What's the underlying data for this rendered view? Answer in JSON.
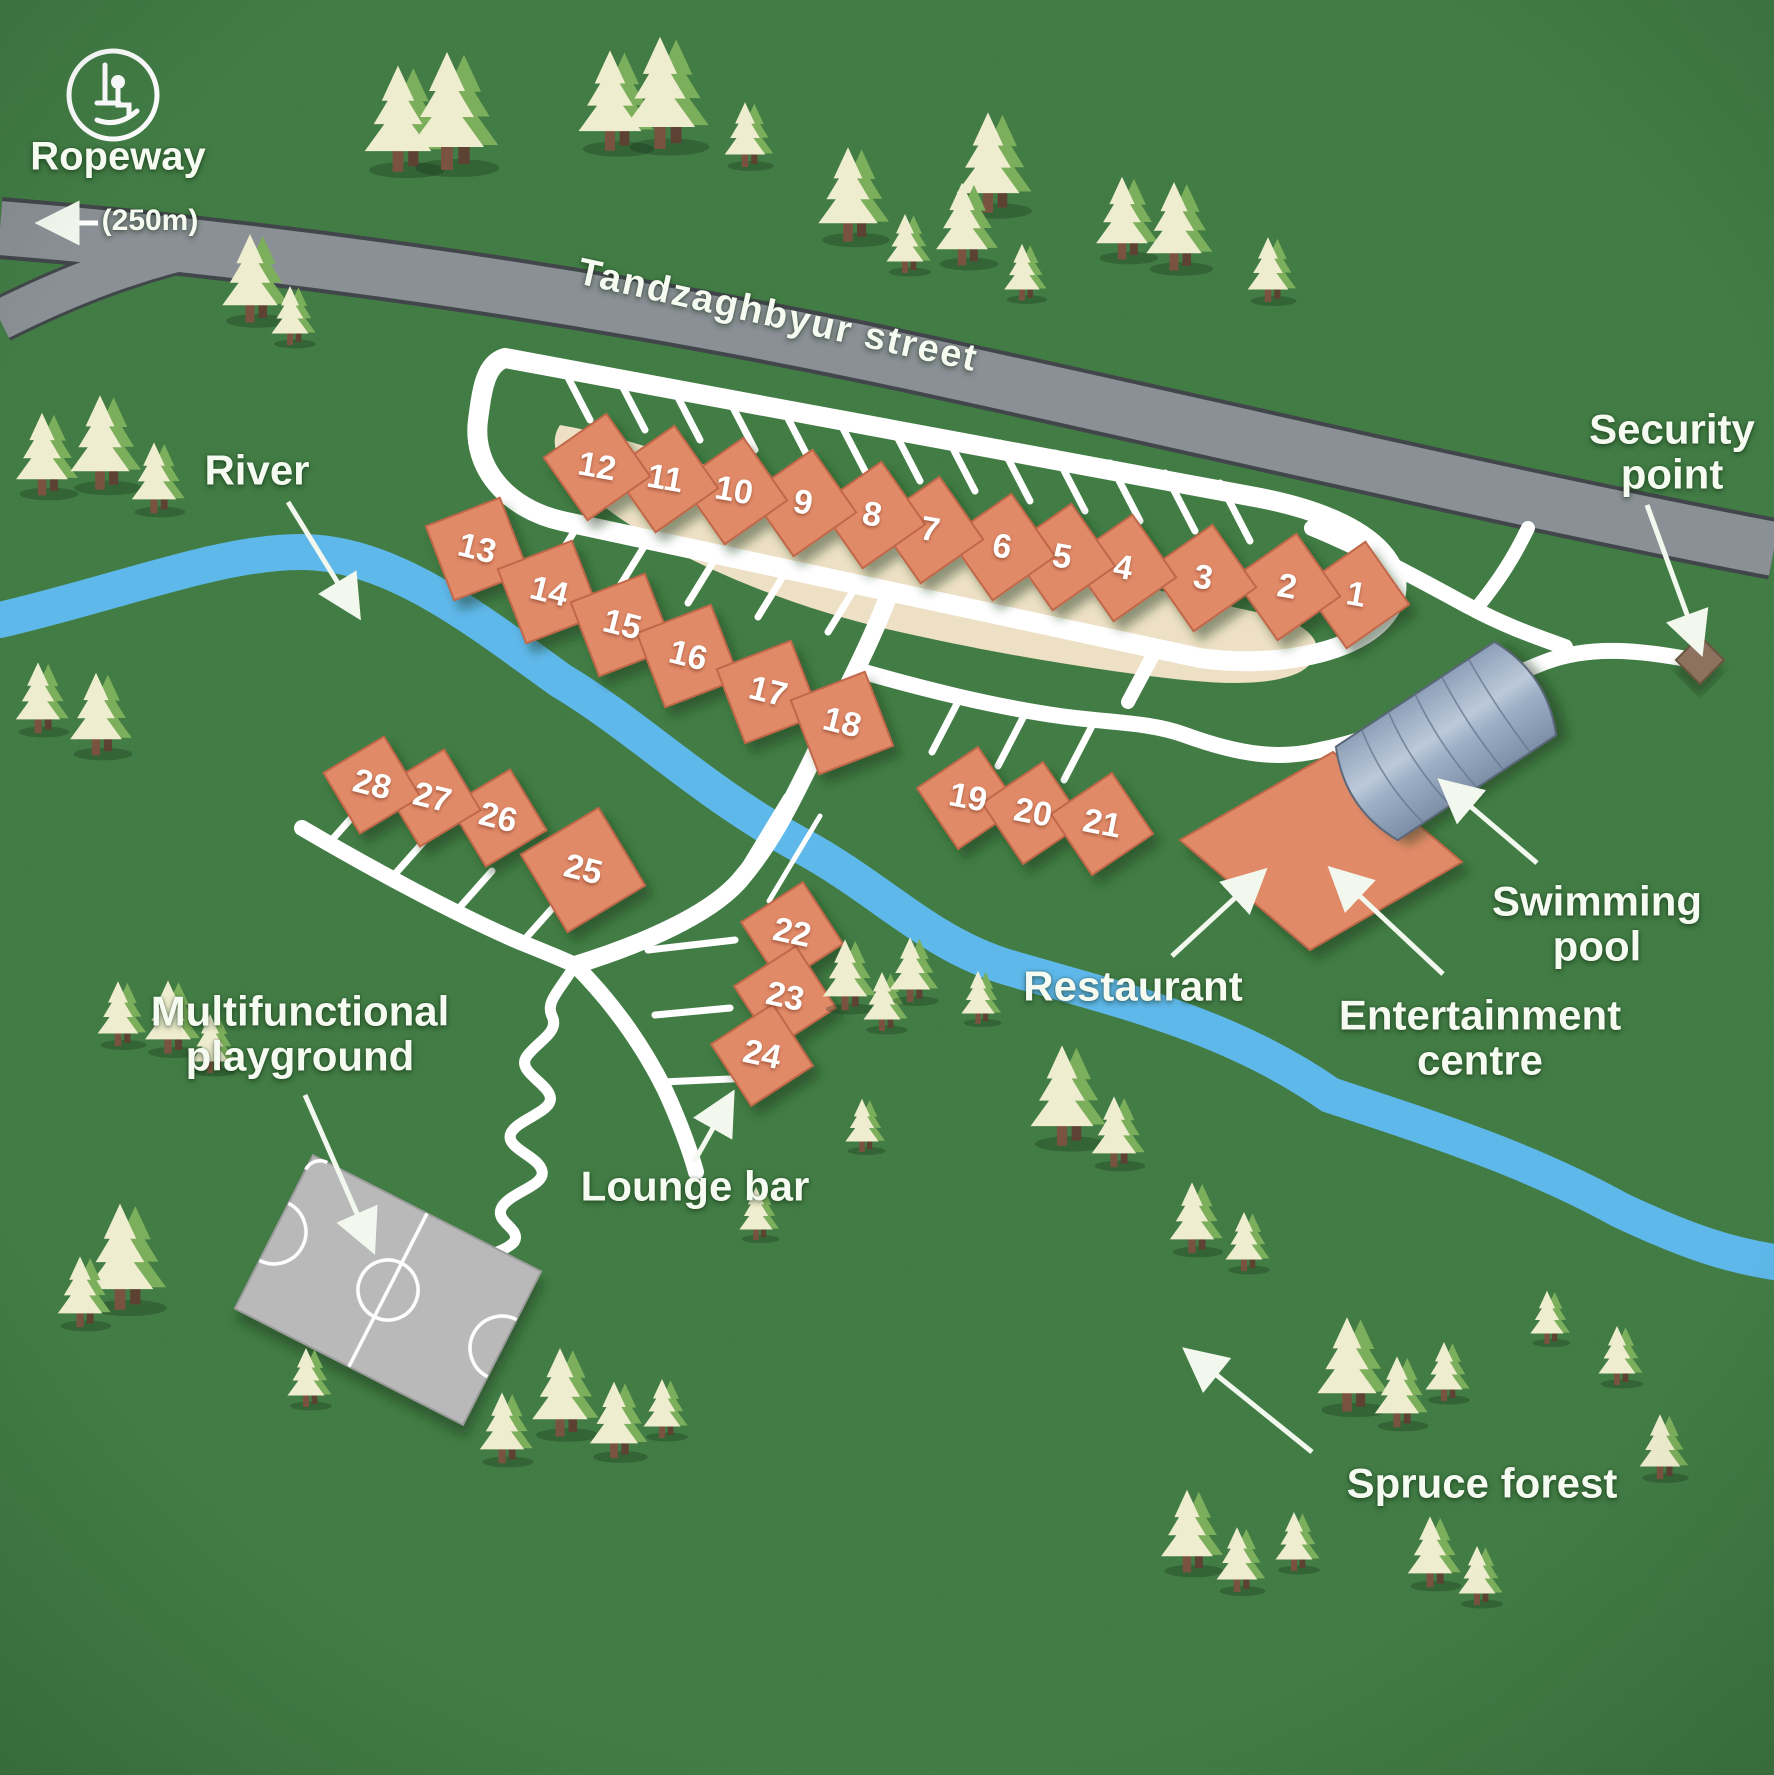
{
  "map_title": "Cottage resort site map",
  "colors": {
    "grass": "#3E7B40",
    "road": "#8A9095",
    "casing": "#41464A",
    "path": "#FFFFFF",
    "river": "#5FB8EA",
    "cottage": "#E08A67",
    "cottageEdge": "#C0674A",
    "sand": "#EDE0C4",
    "pool1": "#B9C7D8",
    "pool2": "#7E90A8",
    "poolEdge": "#5A6678",
    "court": "#B9B9B9",
    "security": "#8D7260",
    "treeCream": "#EFEDCF",
    "treeGreen": "#7CAF5C",
    "trunk": "#7A5340",
    "label": "#F6FBF2"
  },
  "icons": [
    "ropeway-chairlift-icon",
    "arrow-left-icon",
    "pointer-arrow-icon"
  ],
  "labels": {
    "ropeway": {
      "text": "Ropeway",
      "x": 118,
      "y": 157,
      "size": 40,
      "rot": 0
    },
    "distance": {
      "text": "(250m)",
      "x": 150,
      "y": 221,
      "size": 30,
      "rot": 0
    },
    "street": {
      "text": "Tandzaghbyur street",
      "x": 778,
      "y": 316,
      "size": 38,
      "rot": 12.5
    },
    "river": {
      "text": "River",
      "x": 257,
      "y": 470,
      "size": 42,
      "rot": 0
    },
    "security": {
      "line1": "Security",
      "line2": "point",
      "x": 1672,
      "y": 452,
      "size": 42,
      "rot": 0
    },
    "swimming": {
      "line1": "Swimming",
      "line2": "pool",
      "x": 1597,
      "y": 924,
      "size": 42,
      "rot": 0
    },
    "restaurant": {
      "text": "Restaurant",
      "x": 1133,
      "y": 986,
      "size": 42,
      "rot": 0
    },
    "entertainment": {
      "line1": "Entertainment",
      "line2": "centre",
      "x": 1480,
      "y": 1038,
      "size": 42,
      "rot": 0
    },
    "playground": {
      "line1": "Multifunctional",
      "line2": "playground",
      "x": 300,
      "y": 1034,
      "size": 42,
      "rot": 0
    },
    "lounge": {
      "text": "Lounge bar",
      "x": 695,
      "y": 1186,
      "size": 42,
      "rot": 0
    },
    "spruce": {
      "text": "Spruce forest",
      "x": 1482,
      "y": 1483,
      "size": 42,
      "rot": 0
    }
  },
  "number_font_size": 34,
  "buildings": [
    {
      "number": "1",
      "x": 1356,
      "y": 595,
      "rot": 10,
      "lrot": 10,
      "r": 54
    },
    {
      "number": "2",
      "x": 1287,
      "y": 587,
      "rot": 10,
      "lrot": 10,
      "r": 54
    },
    {
      "number": "3",
      "x": 1203,
      "y": 578,
      "rot": 10,
      "lrot": 10,
      "r": 54
    },
    {
      "number": "4",
      "x": 1123,
      "y": 568,
      "rot": 10,
      "lrot": 10,
      "r": 54
    },
    {
      "number": "5",
      "x": 1062,
      "y": 557,
      "rot": 10,
      "lrot": 10,
      "r": 54
    },
    {
      "number": "6",
      "x": 1002,
      "y": 547,
      "rot": 10,
      "lrot": 10,
      "r": 54
    },
    {
      "number": "7",
      "x": 930,
      "y": 530,
      "rot": 10,
      "lrot": 10,
      "r": 54
    },
    {
      "number": "8",
      "x": 872,
      "y": 515,
      "rot": 10,
      "lrot": 10,
      "r": 54
    },
    {
      "number": "9",
      "x": 803,
      "y": 503,
      "rot": 10,
      "lrot": 10,
      "r": 54
    },
    {
      "number": "10",
      "x": 734,
      "y": 491,
      "rot": 10,
      "lrot": 10,
      "r": 54
    },
    {
      "number": "11",
      "x": 665,
      "y": 479,
      "rot": 10,
      "lrot": 10,
      "r": 54
    },
    {
      "number": "12",
      "x": 597,
      "y": 467,
      "rot": 10,
      "lrot": 10,
      "r": 54
    },
    {
      "number": "13",
      "x": 477,
      "y": 549,
      "rot": 24,
      "lrot": 14,
      "r": 56
    },
    {
      "number": "14",
      "x": 549,
      "y": 592,
      "rot": 24,
      "lrot": 14,
      "r": 56
    },
    {
      "number": "15",
      "x": 622,
      "y": 625,
      "rot": 24,
      "lrot": 14,
      "r": 56
    },
    {
      "number": "16",
      "x": 688,
      "y": 656,
      "rot": 24,
      "lrot": 14,
      "r": 56
    },
    {
      "number": "17",
      "x": 768,
      "y": 692,
      "rot": 24,
      "lrot": 14,
      "r": 56
    },
    {
      "number": "18",
      "x": 842,
      "y": 723,
      "rot": 24,
      "lrot": 14,
      "r": 56
    },
    {
      "number": "19",
      "x": 968,
      "y": 798,
      "rot": 11,
      "lrot": 11,
      "r": 52
    },
    {
      "number": "20",
      "x": 1033,
      "y": 813,
      "rot": 11,
      "lrot": 11,
      "r": 52
    },
    {
      "number": "21",
      "x": 1102,
      "y": 824,
      "rot": 11,
      "lrot": 11,
      "r": 52
    },
    {
      "number": "22",
      "x": 792,
      "y": 933,
      "rot": 12,
      "lrot": 12,
      "r": 52
    },
    {
      "number": "23",
      "x": 785,
      "y": 997,
      "rot": 12,
      "lrot": 12,
      "r": 52
    },
    {
      "number": "24",
      "x": 762,
      "y": 1055,
      "rot": 12,
      "lrot": 12,
      "r": 52
    },
    {
      "number": "25",
      "x": 583,
      "y": 870,
      "rot": 14,
      "lrot": 14,
      "r": 64
    },
    {
      "number": "26",
      "x": 498,
      "y": 818,
      "rot": 14,
      "lrot": 14,
      "r": 50
    },
    {
      "number": "27",
      "x": 432,
      "y": 798,
      "rot": 14,
      "lrot": 14,
      "r": 50
    },
    {
      "number": "28",
      "x": 372,
      "y": 785,
      "rot": 14,
      "lrot": 14,
      "r": 50
    }
  ]
}
